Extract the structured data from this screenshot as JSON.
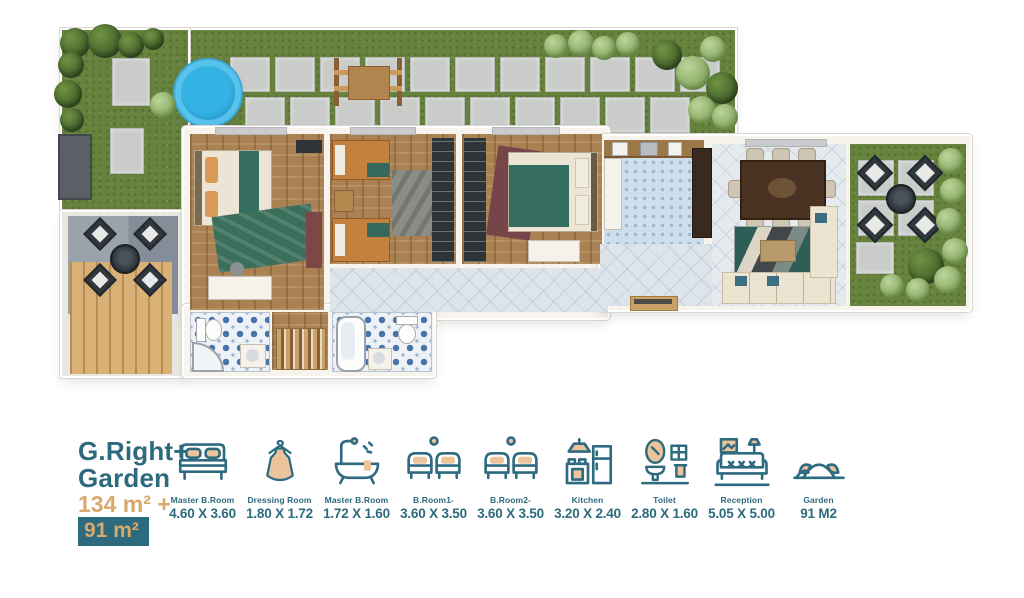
{
  "page": {
    "type": "apartment floor plan sheet"
  },
  "colors": {
    "accent_teal": "#2d6a7e",
    "accent_gold": "#d9a86b",
    "grass": "#66823d",
    "pool_blue": "#1e90c6"
  },
  "legend": {
    "title_line1": "G.Right+",
    "title_line2": "Garden",
    "area_main": "134 m² +",
    "area_garden": "91 m²",
    "items": [
      {
        "icon": "double-bed-icon",
        "label": "Master B.Room",
        "dims": "4.60 X 3.60"
      },
      {
        "icon": "dress-icon",
        "label": "Dressing Room",
        "dims": "1.80 X 1.72"
      },
      {
        "icon": "bathtub-icon",
        "label": "Master B.Room",
        "dims": "1.72 X 1.60"
      },
      {
        "icon": "twin-beds-icon",
        "label": "B.Room1-",
        "dims": "3.60 X 3.50"
      },
      {
        "icon": "twin-beds-icon",
        "label": "B.Room2-",
        "dims": "3.60 X 3.50"
      },
      {
        "icon": "kitchen-icon",
        "label": "Kitchen",
        "dims": "3.20 X 2.40"
      },
      {
        "icon": "toilet-icon",
        "label": "Toilet",
        "dims": "2.80 X 1.60"
      },
      {
        "icon": "reception-icon",
        "label": "Reception",
        "dims": "5.05 X 5.00"
      },
      {
        "icon": "garden-icon",
        "label": "Garden",
        "dims": "91 M2"
      }
    ]
  }
}
